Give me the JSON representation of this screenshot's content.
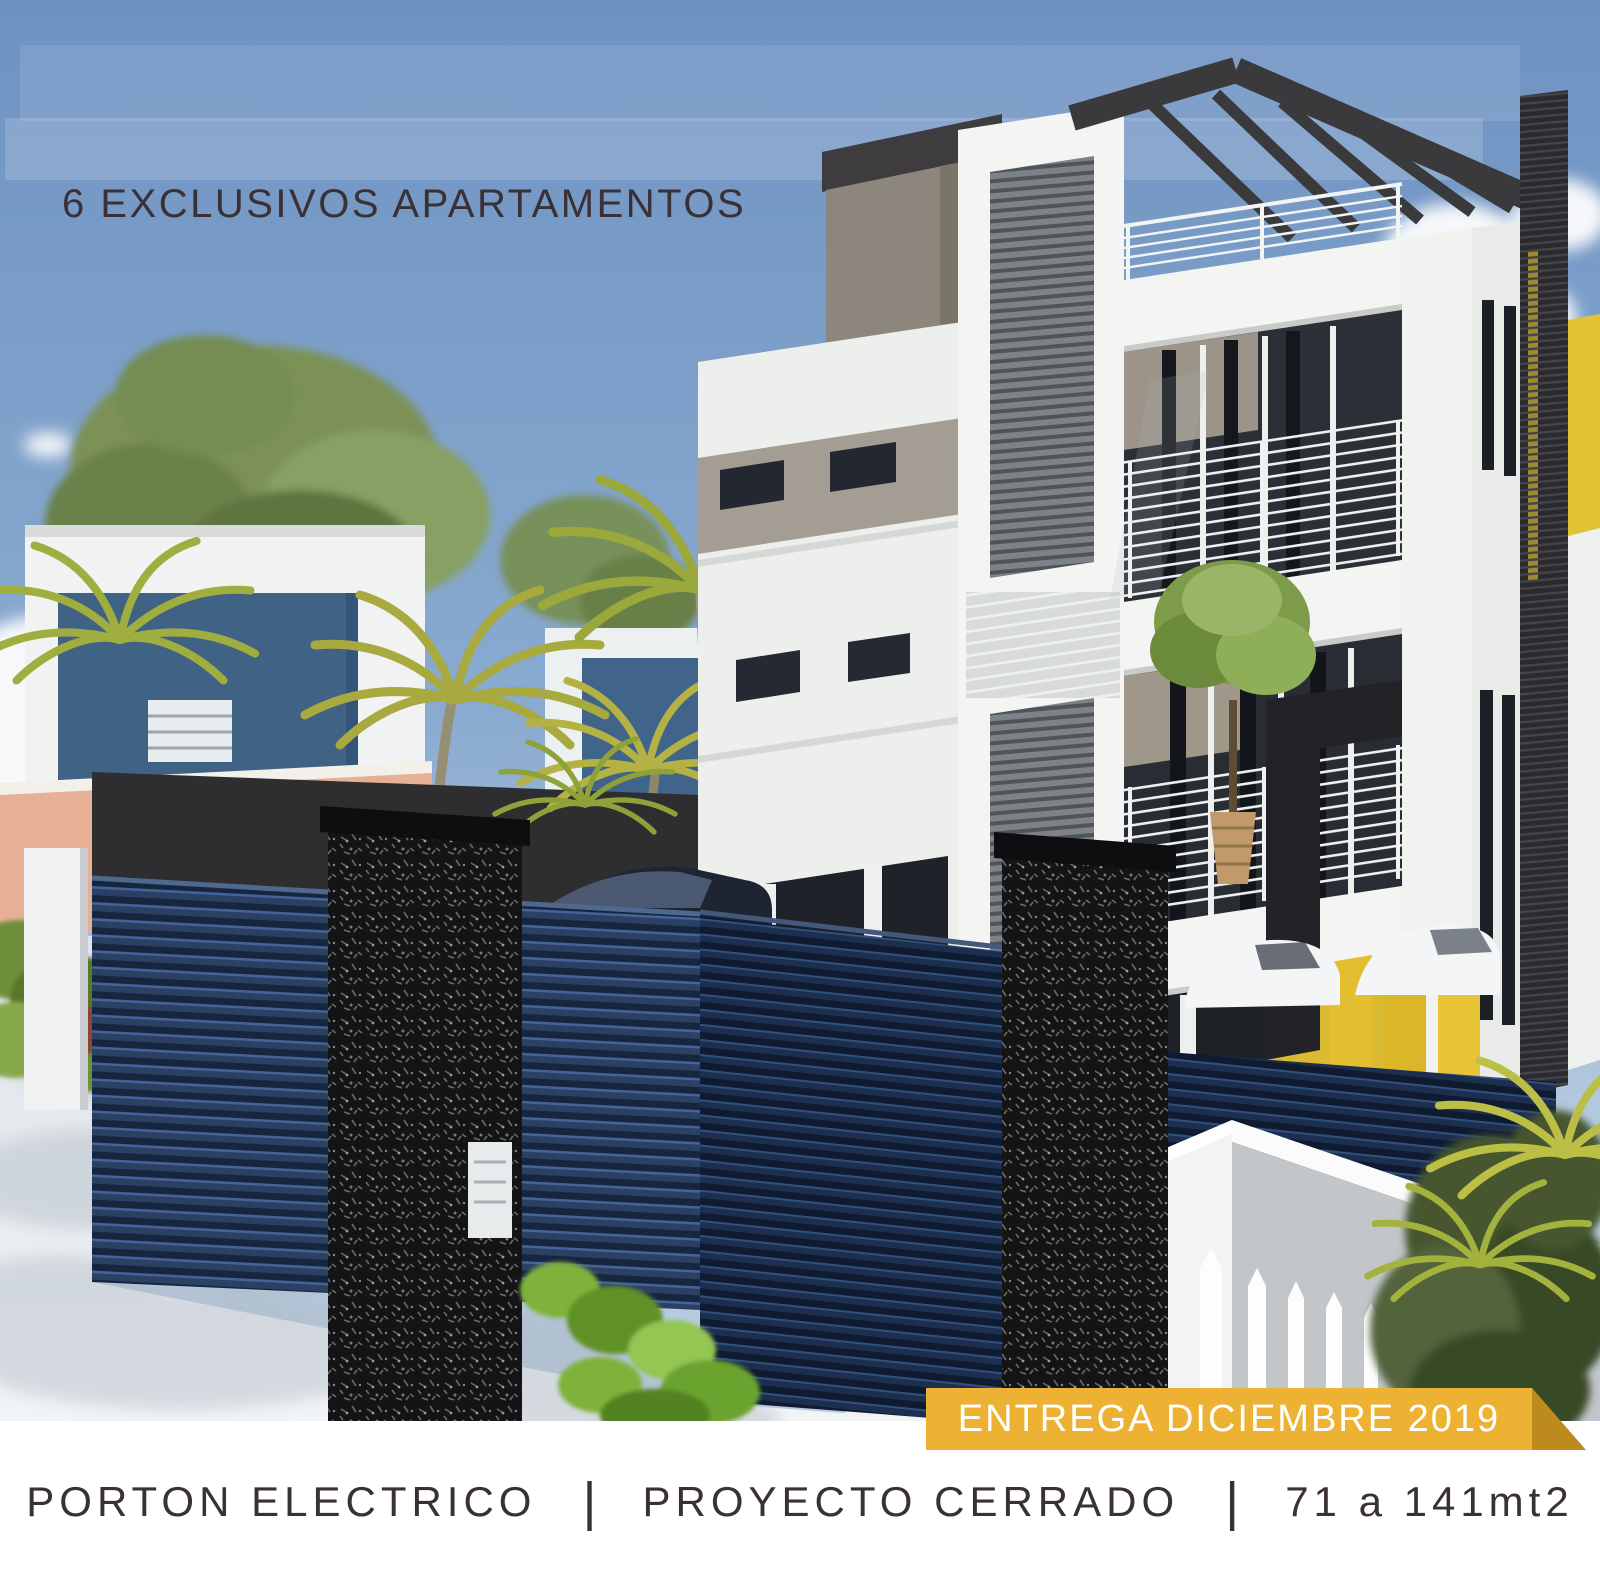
{
  "headline": {
    "text": "6 EXCLUSIVOS APARTAMENTOS"
  },
  "banner": {
    "text": "ENTREGA DICIEMBRE 2019",
    "background": "#edb233",
    "fold_color": "#bd8a1d",
    "text_color": "#ffffff"
  },
  "features": {
    "separator": "|",
    "items": [
      "PORTON ELECTRICO",
      "PROYECTO CERRADO",
      "71 a 141mt2"
    ],
    "text_color": "#3a3136",
    "background": "#ffffff"
  },
  "scene": {
    "description": "Photorealistic 3D render of a modern four-level apartment building with white facade, gray horizontal louver panels, glass balconies with cable railings, rooftop pergola and yellow accent fins; foreground dark navy louvered electric gate with black speckled stone pillars, parked dark sedan, white perimeter wall with picket fence, palm trees, neighboring blue-and-white houses, shrubs and a conifer under a blue sky with clouds",
    "colors": {
      "sky_top": "#6e92c2",
      "sky_horizon": "#b6cbdf",
      "building_white": "#f3f4f2",
      "building_gray": "#8c867d",
      "louver_gray": "#7d8286",
      "glass_dark": "#272b31",
      "accent_yellow": "#e0bd2e",
      "fence_navy": "#1d2f4e",
      "stone_black": "#141416",
      "foliage_green": "#7b9156",
      "palm_yellow_green": "#a8a93e",
      "pavement": "#e9edf0",
      "pink_wall": "#e5b096",
      "neighbor_blue": "#40628a"
    }
  }
}
